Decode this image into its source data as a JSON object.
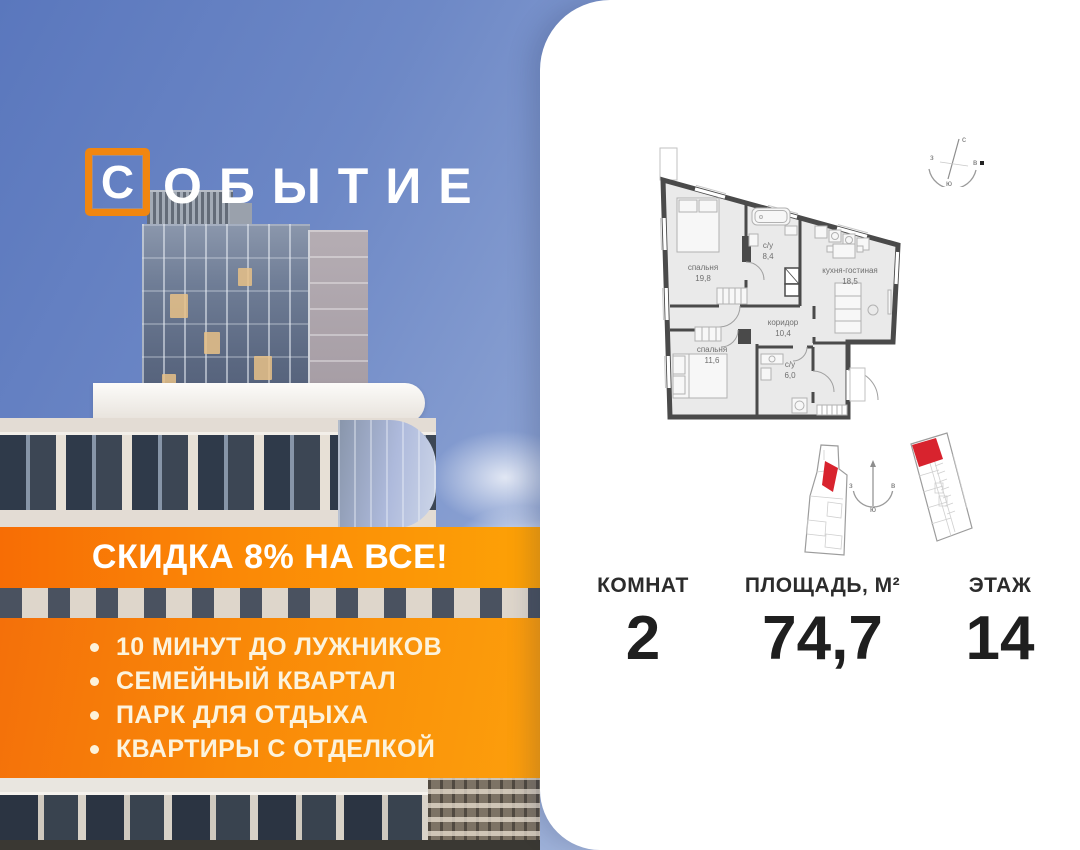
{
  "logo": {
    "boxed_letter": "С",
    "rest": "ОБЫТИЕ"
  },
  "banner": {
    "text": "СКИДКА 8% НА ВСЕ!"
  },
  "features": {
    "items": [
      "10 МИНУТ ДО ЛУЖНИКОВ",
      "СЕМЕЙНЫЙ КВАРТАЛ",
      "ПАРК ДЛЯ ОТДЫХА",
      "КВАРТИРЫ С ОТДЕЛКОЙ"
    ]
  },
  "floor_plan": {
    "rooms": [
      {
        "name": "спальня",
        "area": "19,8"
      },
      {
        "name": "с/у",
        "area": "8,4"
      },
      {
        "name": "кухня-гостиная",
        "area": "18,5"
      },
      {
        "name": "коридор",
        "area": "10,4"
      },
      {
        "name": "спальня",
        "area": "11,6"
      },
      {
        "name": "с/у",
        "area": "6,0"
      }
    ],
    "compass": {
      "north": "с",
      "south": "ю",
      "west": "з",
      "east": "в"
    }
  },
  "stats": [
    {
      "label": "КОМНАТ",
      "value": "2"
    },
    {
      "label": "ПЛОЩАДЬ, М²",
      "value": "74,7"
    },
    {
      "label": "ЭТАЖ",
      "value": "14"
    }
  ],
  "colors": {
    "accent_orange_dark": "#f6700a",
    "accent_orange_light": "#fda206",
    "highlight_red": "#d8232e",
    "sky_blue": "#5a77bd"
  }
}
